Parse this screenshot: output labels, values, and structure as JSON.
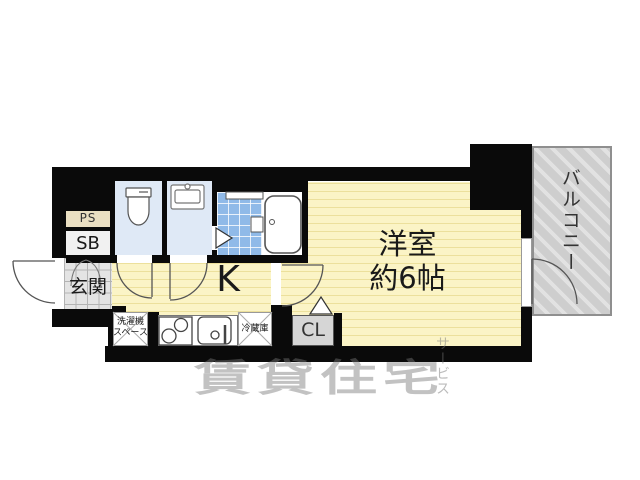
{
  "floorplan": {
    "rooms": {
      "ps": {
        "label": "PS"
      },
      "sb": {
        "label": "SB"
      },
      "entrance": {
        "label": "玄関"
      },
      "kitchen": {
        "label": "K"
      },
      "closet": {
        "label": "CL"
      },
      "western_room": {
        "name": "洋室",
        "size": "約6帖"
      },
      "balcony": {
        "label": "バルコニー"
      },
      "washer_space": {
        "line1": "洗濯機",
        "line2": "スペース"
      },
      "refrigerator": {
        "label": "冷蔵庫"
      }
    },
    "watermark": {
      "main": "賃貸住宅",
      "sub": "サービス"
    },
    "colors": {
      "wall": "#0a0a0a",
      "room_yellow": "#fbf4c6",
      "stripe_yellow": "#ece09c",
      "unit_blue": "#dfe9f6",
      "tile_blue": "#90bae8",
      "entrance_gray": "#e4e4e4",
      "ps_beige": "#eadfc2",
      "sb_white": "#f1f1f1",
      "closet_gray": "#d6d6d6",
      "balcony_gray": "#cecece"
    }
  }
}
